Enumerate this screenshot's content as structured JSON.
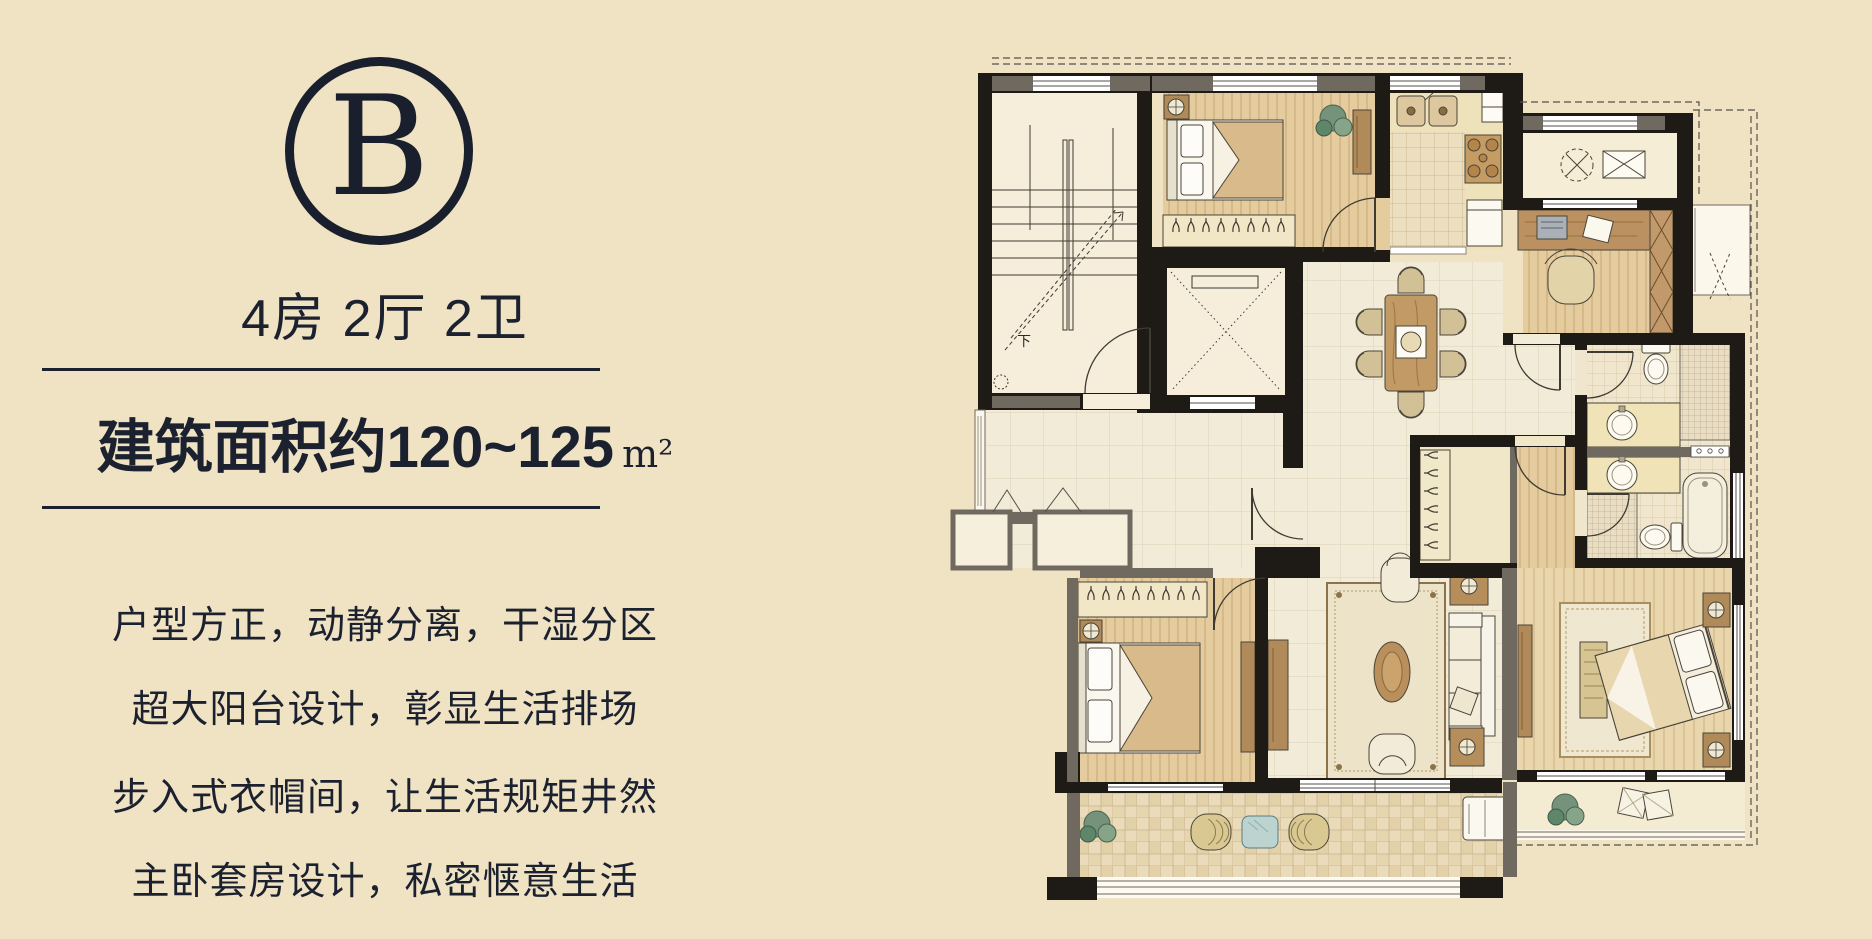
{
  "page": {
    "background_color": "#f0e3c3",
    "ink_color": "#1c2130"
  },
  "left_panel": {
    "logo_letter": "B",
    "title": "4房 2厅 2卫",
    "area_prefix": "建筑面积约",
    "area_value": "120~125",
    "area_unit": "m²",
    "features": [
      "户型方正，动静分离，干湿分区",
      "超大阳台设计，彰显生活排场",
      "步入式衣帽间，让生活规矩井然",
      "主卧套房设计，私密惬意生活"
    ]
  },
  "floor_plan": {
    "stair_label": "下",
    "rooms": [
      "stairwell",
      "elevator",
      "bedroom-north",
      "kitchen",
      "laundry-balcony",
      "study",
      "guest-bathroom",
      "master-bathroom",
      "walk-in-closet",
      "master-bedroom",
      "living-room",
      "dining-room",
      "bedroom-west",
      "south-balcony",
      "master-balcony",
      "entry-hall"
    ],
    "wall_color": "#1e1b17",
    "pier_color": "#6f695f",
    "wood_floor_color": "#e4cc9e",
    "marble_floor_color": "#f2ebd7"
  }
}
